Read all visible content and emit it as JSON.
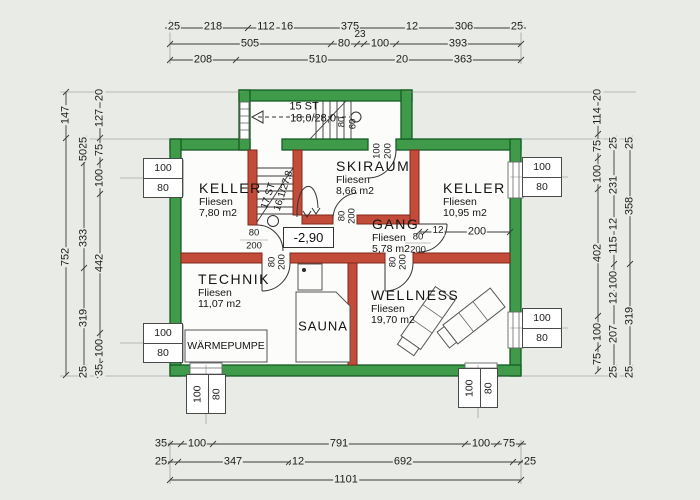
{
  "colors": {
    "outer_wall_green": "#3f9b4a",
    "outer_wall_edge": "#175c26",
    "inner_wall_red": "#c34b39",
    "inner_wall_edge": "#80281c",
    "paper": "#e9ebe7",
    "floor_white": "#fcfcfa",
    "line": "#3a3a3a"
  },
  "rooms": {
    "keller1": {
      "name": "KELLER",
      "floor": "Fliesen",
      "area": "7,80 m2"
    },
    "skiraum": {
      "name": "SKIRAUM",
      "floor": "Fliesen",
      "area": "8,66 m2"
    },
    "keller2": {
      "name": "KELLER",
      "floor": "Fliesen",
      "area": "10,95 m2"
    },
    "gang": {
      "name": "GANG",
      "floor": "Fliesen",
      "area": "5,78 m2"
    },
    "technik": {
      "name": "TECHNIK",
      "floor": "Fliesen",
      "area": "11,07 m2"
    },
    "wellness": {
      "name": "WELLNESS",
      "floor": "Fliesen",
      "area": "19,70 m2"
    },
    "sauna": {
      "name": "SAUNA"
    },
    "waermepumpe": {
      "name": "WÄRMEPUMPE"
    }
  },
  "level_marker": "-2,90",
  "stairs": {
    "upper": {
      "steps": "15 ST",
      "tread": "18,0/28,0"
    },
    "lower": {
      "steps": "17 ST",
      "tread": "16,1/27,8"
    }
  },
  "doors": {
    "keller1": {
      "w": "80",
      "h": "200"
    },
    "keller2": {
      "w": "80",
      "h": "200"
    },
    "technik": {
      "w": "80",
      "h": "200"
    },
    "wellness": {
      "w": "80",
      "h": "200"
    },
    "skiraum": {
      "w": "80",
      "h": "200"
    },
    "entrance": {
      "w": "100",
      "h": "200"
    },
    "stair_rail": {
      "a": "80",
      "b": "60"
    }
  },
  "windows": {
    "width": "100",
    "height": "80"
  },
  "dims": {
    "top": {
      "r1": [
        "25",
        "218",
        "112",
        "16",
        "375",
        "12",
        "306",
        "25"
      ],
      "r2": [
        "505",
        "80",
        "23",
        "100",
        "393"
      ],
      "r3": [
        "208",
        "510",
        "20",
        "363"
      ]
    },
    "bottom": {
      "r1": [
        "35",
        "100",
        "791",
        "100",
        "75"
      ],
      "r2": [
        "25",
        "347",
        "12",
        "692",
        "25"
      ],
      "r3": [
        "1101"
      ]
    },
    "left": {
      "a": [
        "147",
        "752"
      ],
      "b": [
        "25",
        "50",
        "333",
        "319",
        "25"
      ],
      "c": [
        "20",
        "127",
        "75",
        "100",
        "442",
        "100",
        "35"
      ]
    },
    "right": {
      "a": [
        "20",
        "114",
        "75",
        "100",
        "402",
        "100",
        "75"
      ],
      "b": [
        "25",
        "231",
        "12",
        "115",
        "100",
        "12",
        "207",
        "25"
      ],
      "c": [
        "25",
        "358",
        "319",
        "25"
      ]
    },
    "interior": {
      "gap": "12",
      "span": "200"
    }
  }
}
